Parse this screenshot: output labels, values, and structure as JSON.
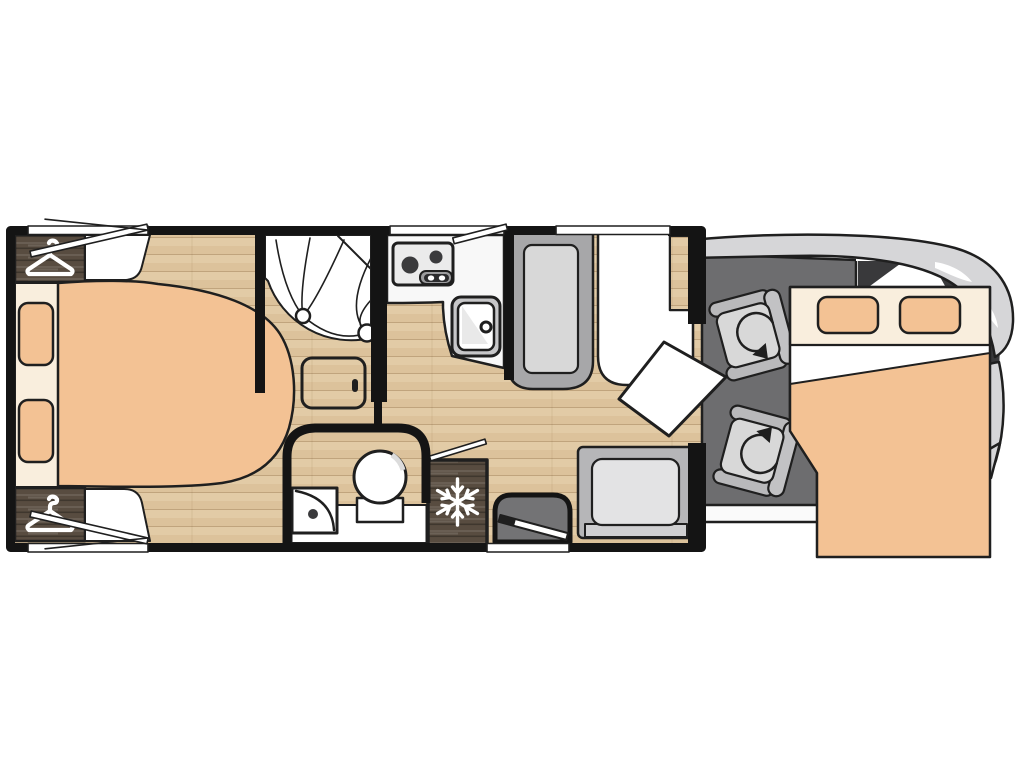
{
  "document": {
    "kind": "motorhome-floorplan-top-view",
    "visible_text": []
  },
  "palette": {
    "line": "#1f1f1f",
    "wallBlack": "#141414",
    "floorTan": "#dcc29b",
    "floorTanLight": "#e7d2ae",
    "darkWood": "#584c40",
    "cream": "#f9eedd",
    "peach": "#f3c294",
    "white": "#ffffff",
    "counterWhite": "#f8f8f8",
    "seatBack": "#a7a7a9",
    "cushion": "#d8d8d8",
    "benchOuter": "#b6b6b8",
    "cushionLight": "#e3e3e4",
    "cabFloor": "#6d6d6f",
    "bodyGray": "#d6d6d8",
    "glassDark": "#39393b",
    "applianceGray": "#c7c7c9",
    "hobFace": "#ebebeb",
    "burnerDark": "#3a3a3c",
    "stepGray": "#737375"
  },
  "icons": [
    "coat-hanger-icon",
    "coat-hanger-icon",
    "snowflake-icon",
    "swivel-arrow-icon",
    "swivel-arrow-icon"
  ],
  "features": [
    "rear-island-bed",
    "wardrobe-top",
    "wardrobe-bottom",
    "rear-mattress-pillows",
    "corner-shower",
    "washroom-toilet",
    "washroom-basin",
    "side-shelf",
    "kitchen-hob",
    "kitchen-sink",
    "kitchen-counter",
    "refrigerator",
    "dinette-side-bench",
    "dinette-front-seat",
    "dinette-table",
    "dinette-rear-bench",
    "entry-step",
    "entry-door-open",
    "window-flap-rear-top",
    "window-flap-rear-bottom",
    "window-flap-kitchen",
    "cab-swivel-seat-left",
    "cab-swivel-seat-right",
    "drop-down-bed",
    "vehicle-cab-outline"
  ]
}
